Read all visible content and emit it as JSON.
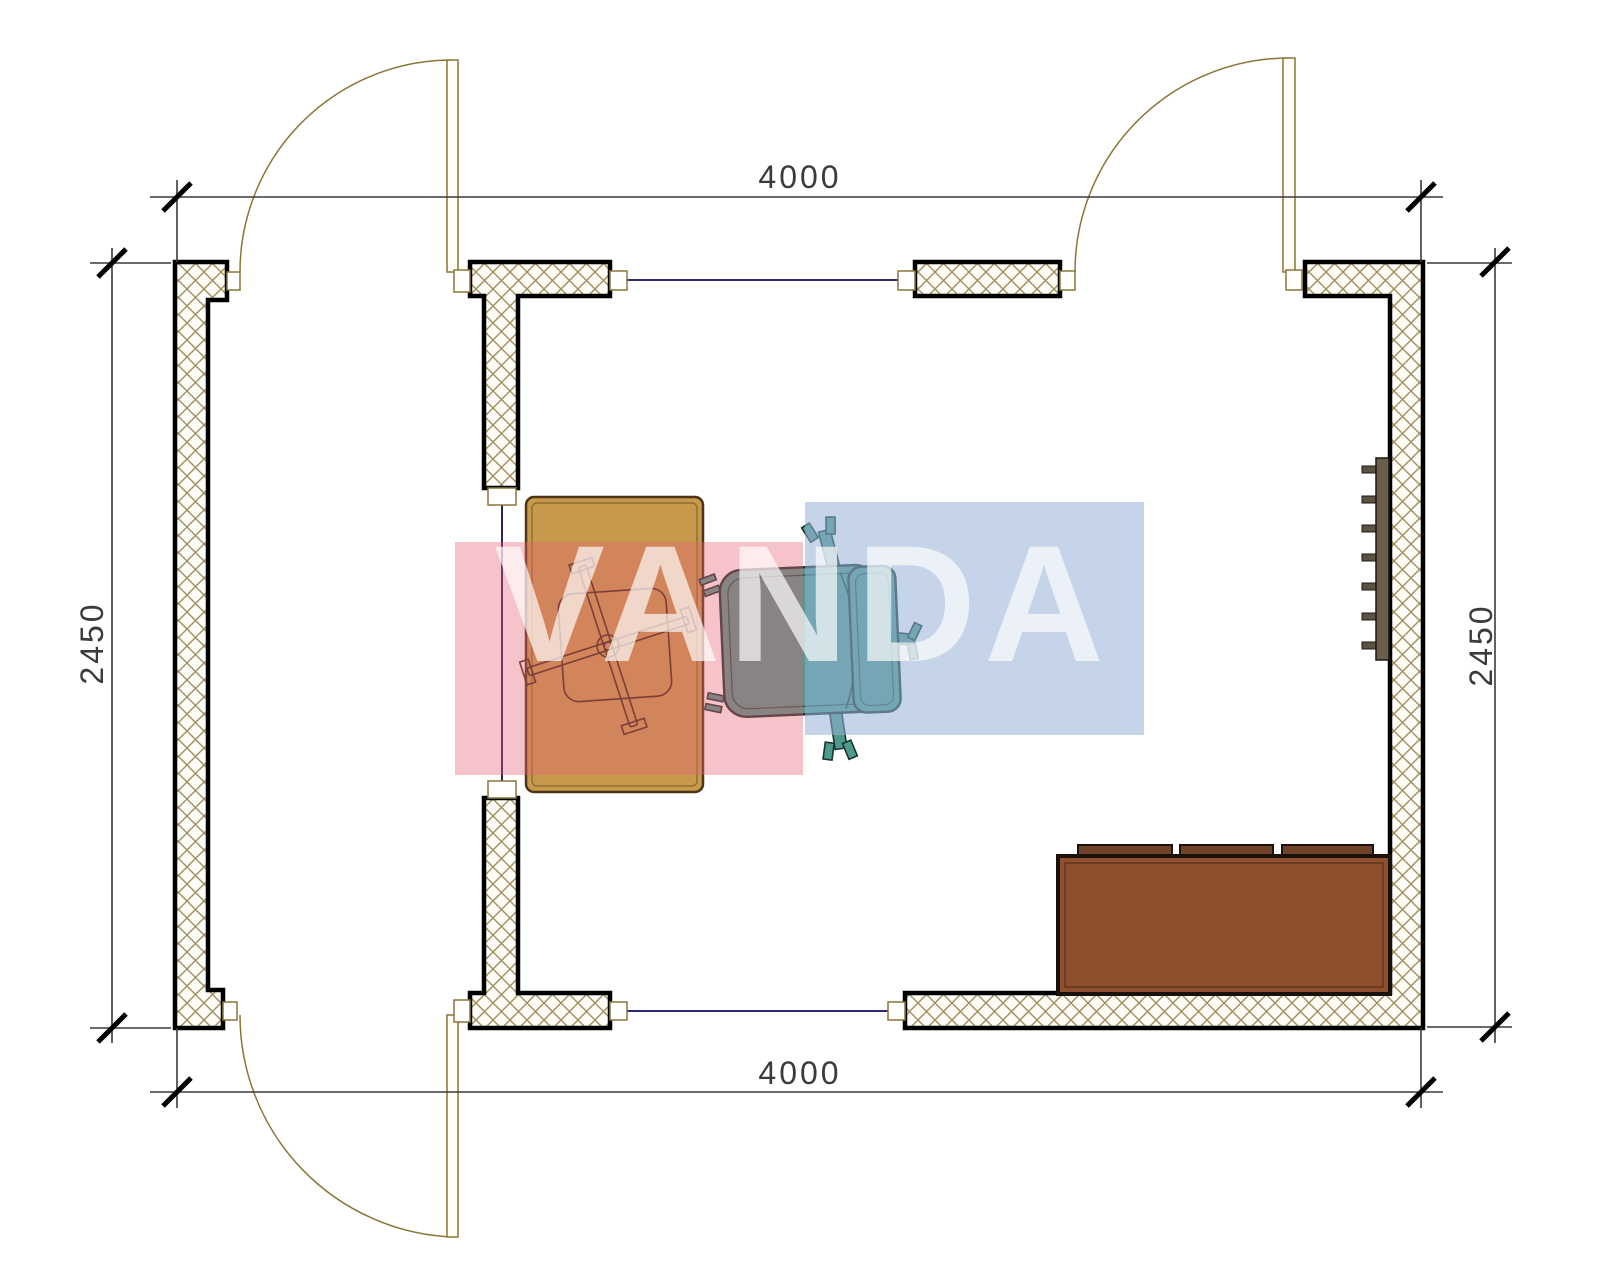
{
  "drawing": {
    "type": "architectural-floor-plan",
    "dimensions": {
      "top": "4000",
      "bottom": "4000",
      "left": "2450",
      "right": "2450"
    },
    "watermark": {
      "text": "VANDA",
      "pink_color": "#e76174",
      "blue_color": "#96b1d5",
      "text_color": "#ffffff"
    },
    "colors": {
      "wall_hatch": "#a08e5e",
      "wall_outline": "#000000",
      "window_line": "#2b2b72",
      "door_line": "#8b7536",
      "dimension_line": "#3a3a3a",
      "desk": "#c6994c",
      "office_chair_outline": "#3a2a12",
      "armchair": "#4f9a8e",
      "sofa": "#8d4f2d",
      "sofa_cushion": "#70422a",
      "radiator": "#5e5342"
    },
    "objects": {
      "desk": "desk",
      "office_chair": "office-chair",
      "armchair": "armchair",
      "sofa": "three-seat-sofa",
      "radiator": "radiator"
    }
  }
}
